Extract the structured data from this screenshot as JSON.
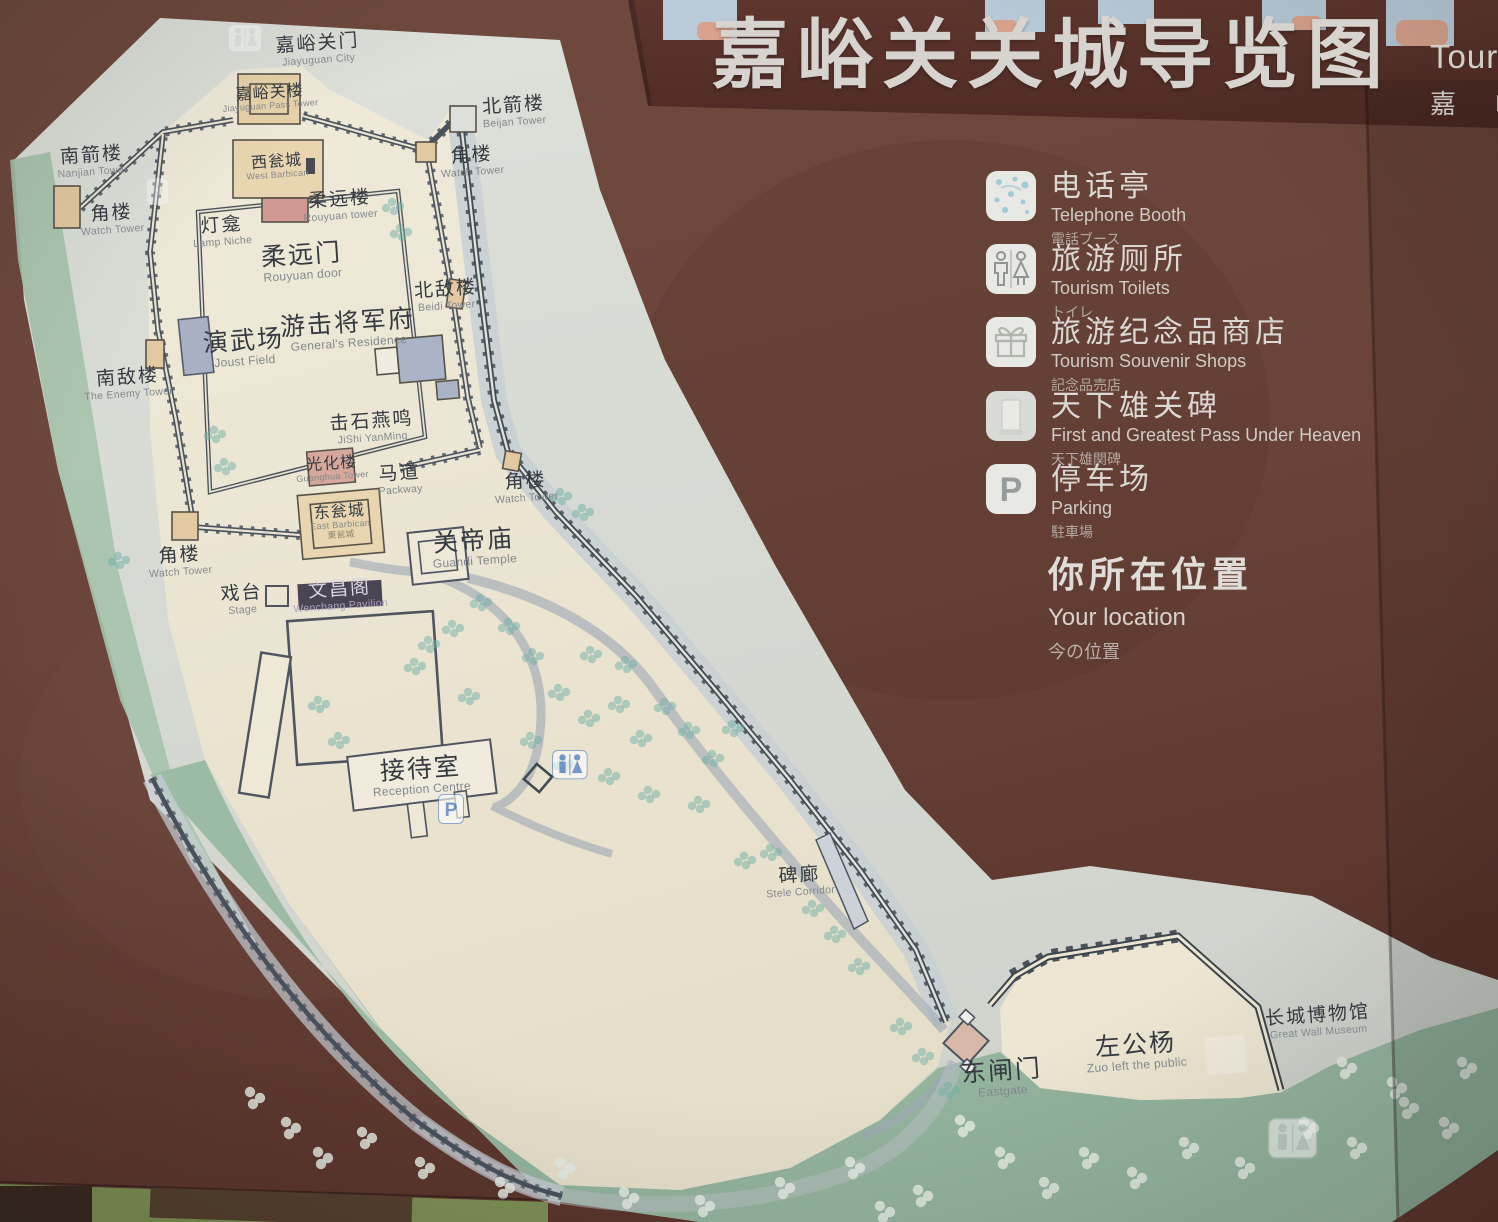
{
  "title": {
    "zh": "嘉峪关关城导览图",
    "en_partial": "Touri",
    "zh_partial": "嘉 峪"
  },
  "legend": {
    "items": [
      {
        "id": "telephone-booth",
        "icon": "phone",
        "zh": "电话亭",
        "en": "Telephone Booth",
        "ja": "電話ブース",
        "x": 985,
        "y": 170
      },
      {
        "id": "tourism-toilets",
        "icon": "toilets",
        "zh": "旅游厕所",
        "en": "Tourism Toilets",
        "ja": "トイレ",
        "x": 985,
        "y": 243
      },
      {
        "id": "souvenir-shops",
        "icon": "gift",
        "zh": "旅游纪念品商店",
        "en": "Tourism Souvenir Shops",
        "ja": "記念品売店",
        "x": 985,
        "y": 316
      },
      {
        "id": "pass-stele",
        "icon": "stele",
        "zh": "天下雄关碑",
        "en": "First and Greatest Pass Under Heaven",
        "ja": "天下雄関碑",
        "x": 985,
        "y": 390
      },
      {
        "id": "parking",
        "icon": "parking",
        "zh": "停车场",
        "en": "Parking",
        "ja": "駐車場",
        "x": 985,
        "y": 463
      }
    ],
    "location": {
      "zh": "你所在位置",
      "en": "Your location",
      "ja": "今の位置"
    }
  },
  "map": {
    "labels": [
      {
        "id": "jiayuguan-gate",
        "zh": "嘉峪关门",
        "en": "Jiayuguan City",
        "x": 318,
        "y": 50,
        "size": "m"
      },
      {
        "id": "jiayuguan-pass-tower",
        "zh": "嘉峪关楼",
        "en": "Jiayuguan Pass Tower",
        "x": 270,
        "y": 98,
        "size": "s"
      },
      {
        "id": "beijian-tower",
        "zh": "北箭楼",
        "en": "Beijan Tower",
        "x": 514,
        "y": 112,
        "size": "m"
      },
      {
        "id": "nanjian-tower",
        "zh": "南箭楼",
        "en": "Nanjian Tower",
        "x": 92,
        "y": 162,
        "size": "m"
      },
      {
        "id": "watch-tower-nw",
        "zh": "角楼",
        "en": "Watch  Tower",
        "x": 112,
        "y": 220,
        "size": "m"
      },
      {
        "id": "west-barbican",
        "zh": "西瓮城",
        "en": "West Barbican",
        "x": 277,
        "y": 167,
        "size": "s"
      },
      {
        "id": "lamp-niche",
        "zh": "灯龛",
        "en": "Lamp Niche",
        "x": 222,
        "y": 232,
        "size": "m"
      },
      {
        "id": "rouyuan-tower",
        "zh": "柔远楼",
        "en": "Rouyuan tower",
        "x": 340,
        "y": 206,
        "size": "m"
      },
      {
        "id": "rouyuan-door",
        "zh": "柔远门",
        "en": "Rouyuan door",
        "x": 302,
        "y": 262,
        "size": "l"
      },
      {
        "id": "watch-tower-ne",
        "zh": "角楼",
        "en": "Watch Tower",
        "x": 472,
        "y": 162,
        "size": "m"
      },
      {
        "id": "beidi-tower",
        "zh": "北敌楼",
        "en": "Beidi Tower",
        "x": 446,
        "y": 296,
        "size": "m"
      },
      {
        "id": "generals-residence",
        "zh": "游击将军府",
        "en": "General's Residence",
        "x": 348,
        "y": 330,
        "size": "l"
      },
      {
        "id": "joust-field",
        "zh": "演武场",
        "en": "Joust Field",
        "x": 244,
        "y": 348,
        "size": "l"
      },
      {
        "id": "enemy-tower",
        "zh": "南敌楼",
        "en": "The Enemy Tower",
        "x": 128,
        "y": 384,
        "size": "m"
      },
      {
        "id": "jishi-yanming",
        "zh": "击石燕鸣",
        "en": "JiShi YanMing",
        "x": 372,
        "y": 428,
        "size": "m"
      },
      {
        "id": "guanghua-tower",
        "zh": "光化楼",
        "en": "Guanghua Tower",
        "x": 332,
        "y": 469,
        "size": "s"
      },
      {
        "id": "packway",
        "zh": "马道",
        "en": "Packway",
        "x": 400,
        "y": 480,
        "size": "m"
      },
      {
        "id": "watch-tower-se",
        "zh": "角楼",
        "en": "Watch  Tower",
        "x": 526,
        "y": 488,
        "size": "m"
      },
      {
        "id": "east-barbican",
        "zh": "东瓮城",
        "en": "East Barbican",
        "ja": "東瓮城",
        "x": 340,
        "y": 522,
        "size": "s"
      },
      {
        "id": "watch-tower-sw",
        "zh": "角楼",
        "en": "Watch  Tower",
        "x": 180,
        "y": 562,
        "size": "m"
      },
      {
        "id": "guandi-temple",
        "zh": "关帝庙",
        "en": "Guandi Temple",
        "x": 474,
        "y": 548,
        "size": "l"
      },
      {
        "id": "stage",
        "zh": "戏台",
        "en": "Stage",
        "x": 242,
        "y": 600,
        "size": "m"
      },
      {
        "id": "wenchang-pavilion",
        "zh": "文昌阁",
        "en": "Wenchang Pavilion",
        "x": 340,
        "y": 596,
        "size": "m",
        "theme": "dark"
      },
      {
        "id": "reception-centre",
        "zh": "接待室",
        "en": "Reception Centre",
        "x": 421,
        "y": 776,
        "size": "l"
      },
      {
        "id": "stele-corridor",
        "zh": "碑廊",
        "en": "Stele Corridor",
        "x": 800,
        "y": 882,
        "size": "m"
      },
      {
        "id": "east-gate",
        "zh": "东闸门",
        "en": "Eastgate",
        "x": 1002,
        "y": 1078,
        "size": "l"
      },
      {
        "id": "zuogong-poplar",
        "zh": "左公杨",
        "en": "Zuo left the public",
        "x": 1136,
        "y": 1052,
        "size": "l"
      },
      {
        "id": "great-wall-museum",
        "zh": "长城博物馆",
        "en": "Great Wall Museum",
        "x": 1318,
        "y": 1022,
        "size": "m"
      }
    ],
    "icons": [
      {
        "type": "toilets",
        "x": 228,
        "y": 24,
        "tint": "#dde3e6",
        "opacity": 0.55,
        "scale": 1
      },
      {
        "type": "parking",
        "x": 146,
        "y": 178,
        "tint": "#dde3e6",
        "opacity": 0.45,
        "scale": 0.9
      },
      {
        "type": "parking",
        "x": 438,
        "y": 794,
        "tint": "#5b88c9",
        "opacity": 0.8,
        "scale": 1
      },
      {
        "type": "toilets",
        "x": 552,
        "y": 750,
        "tint": "#5b88c9",
        "opacity": 0.8,
        "scale": 1.05
      },
      {
        "type": "toilets",
        "x": 1268,
        "y": 1118,
        "tint": "#c9d4d2",
        "opacity": 0.75,
        "scale": 1.45
      }
    ],
    "trees": [
      [
        392,
        202
      ],
      [
        400,
        228
      ],
      [
        214,
        430
      ],
      [
        224,
        462
      ],
      [
        480,
        598
      ],
      [
        508,
        622
      ],
      [
        532,
        652
      ],
      [
        558,
        688
      ],
      [
        588,
        714
      ],
      [
        618,
        700
      ],
      [
        640,
        734
      ],
      [
        664,
        702
      ],
      [
        688,
        726
      ],
      [
        712,
        754
      ],
      [
        732,
        724
      ],
      [
        562,
        760
      ],
      [
        608,
        772
      ],
      [
        648,
        790
      ],
      [
        698,
        800
      ],
      [
        744,
        856
      ],
      [
        770,
        848
      ],
      [
        812,
        904
      ],
      [
        834,
        930
      ],
      [
        858,
        962
      ],
      [
        318,
        700
      ],
      [
        338,
        736
      ],
      [
        428,
        640
      ],
      [
        452,
        624
      ],
      [
        414,
        662
      ],
      [
        468,
        692
      ],
      [
        590,
        650
      ],
      [
        625,
        660
      ],
      [
        530,
        736
      ],
      [
        900,
        1022
      ],
      [
        922,
        1052
      ],
      [
        948,
        1086
      ],
      [
        560,
        492
      ],
      [
        582,
        508
      ],
      [
        118,
        556
      ]
    ],
    "trees_white": [
      [
        250,
        1092
      ],
      [
        286,
        1122
      ],
      [
        318,
        1152
      ],
      [
        362,
        1132
      ],
      [
        420,
        1162
      ],
      [
        500,
        1182
      ],
      [
        560,
        1162
      ],
      [
        624,
        1192
      ],
      [
        700,
        1200
      ],
      [
        780,
        1182
      ],
      [
        850,
        1162
      ],
      [
        918,
        1190
      ],
      [
        1000,
        1152
      ],
      [
        1044,
        1182
      ],
      [
        1084,
        1152
      ],
      [
        1132,
        1172
      ],
      [
        1184,
        1142
      ],
      [
        1240,
        1162
      ],
      [
        1304,
        1122
      ],
      [
        1352,
        1142
      ],
      [
        1404,
        1102
      ],
      [
        1444,
        1122
      ],
      [
        1342,
        1062
      ],
      [
        1392,
        1082
      ],
      [
        1462,
        1062
      ],
      [
        960,
        1120
      ],
      [
        880,
        1206
      ]
    ]
  },
  "colors": {
    "board": "#68453a",
    "board_dark": "#57332b",
    "strip": "#5a332c",
    "sky": "#b9cbd9",
    "salmon": "#d8a28c",
    "paper": "#d6d9d1",
    "cream": "#ebe5d1",
    "green": "#a6c3ac",
    "green_dark": "#8fb29c",
    "wall": "#4a535d",
    "road": "#9fa9b6",
    "tree": "#6fb0a6",
    "tree_light": "#e4ebe2",
    "tan": "#e7d2a9",
    "red_building": "#d09a92",
    "gray_building": "#aab0c4"
  }
}
